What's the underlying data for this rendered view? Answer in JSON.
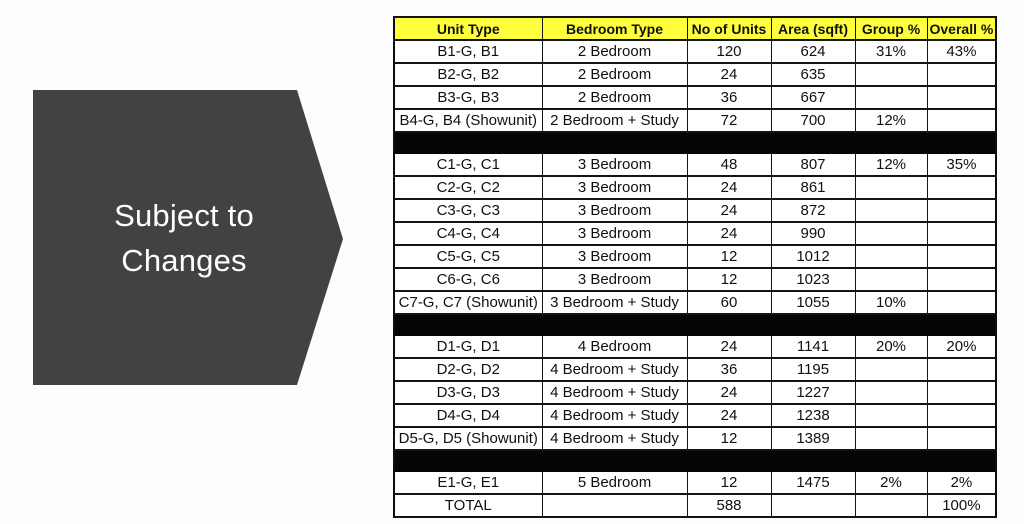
{
  "page": {
    "background_color": "#fdfdfd"
  },
  "callout": {
    "line1": "Subject to",
    "line2": "Changes",
    "shape_color": "#424242",
    "text_color": "#ffffff"
  },
  "table": {
    "header_bg": "#ffff3e",
    "divider_color": "#050505",
    "columns": [
      "Unit Type",
      "Bedroom Type",
      "No of Units",
      "Area (sqft)",
      "Group %",
      "Overall %"
    ],
    "column_keys": [
      "unit-type",
      "bedroom-type",
      "no-of-units",
      "area-sqft",
      "group-pct",
      "overall-pct"
    ],
    "rows": [
      {
        "type": "data",
        "cells": [
          "B1-G, B1",
          "2 Bedroom",
          "120",
          "624",
          "31%",
          "43%"
        ]
      },
      {
        "type": "data",
        "cells": [
          "B2-G, B2",
          "2 Bedroom",
          "24",
          "635",
          "",
          ""
        ]
      },
      {
        "type": "data",
        "cells": [
          "B3-G, B3",
          "2 Bedroom",
          "36",
          "667",
          "",
          ""
        ]
      },
      {
        "type": "data",
        "cells": [
          "B4-G, B4 (Showunit)",
          "2 Bedroom + Study",
          "72",
          "700",
          "12%",
          ""
        ]
      },
      {
        "type": "separator",
        "cells": []
      },
      {
        "type": "data",
        "cells": [
          "C1-G, C1",
          "3 Bedroom",
          "48",
          "807",
          "12%",
          "35%"
        ]
      },
      {
        "type": "data",
        "cells": [
          "C2-G, C2",
          "3 Bedroom",
          "24",
          "861",
          "",
          ""
        ]
      },
      {
        "type": "data",
        "cells": [
          "C3-G, C3",
          "3 Bedroom",
          "24",
          "872",
          "",
          ""
        ]
      },
      {
        "type": "data",
        "cells": [
          "C4-G, C4",
          "3 Bedroom",
          "24",
          "990",
          "",
          ""
        ]
      },
      {
        "type": "data",
        "cells": [
          "C5-G, C5",
          "3 Bedroom",
          "12",
          "1012",
          "",
          ""
        ]
      },
      {
        "type": "data",
        "cells": [
          "C6-G, C6",
          "3 Bedroom",
          "12",
          "1023",
          "",
          ""
        ]
      },
      {
        "type": "data",
        "cells": [
          "C7-G, C7 (Showunit)",
          "3 Bedroom + Study",
          "60",
          "1055",
          "10%",
          ""
        ]
      },
      {
        "type": "separator",
        "cells": []
      },
      {
        "type": "data",
        "cells": [
          "D1-G, D1",
          "4 Bedroom",
          "24",
          "1141",
          "20%",
          "20%"
        ]
      },
      {
        "type": "data",
        "cells": [
          "D2-G, D2",
          "4 Bedroom + Study",
          "36",
          "1195",
          "",
          ""
        ]
      },
      {
        "type": "data",
        "cells": [
          "D3-G, D3",
          "4 Bedroom + Study",
          "24",
          "1227",
          "",
          ""
        ]
      },
      {
        "type": "data",
        "cells": [
          "D4-G, D4",
          "4 Bedroom + Study",
          "24",
          "1238",
          "",
          ""
        ]
      },
      {
        "type": "data",
        "cells": [
          "D5-G, D5 (Showunit)",
          "4 Bedroom + Study",
          "12",
          "1389",
          "",
          ""
        ]
      },
      {
        "type": "separator",
        "cells": []
      },
      {
        "type": "data",
        "cells": [
          "E1-G, E1",
          "5 Bedroom",
          "12",
          "1475",
          "2%",
          "2%"
        ]
      },
      {
        "type": "total",
        "cells": [
          "TOTAL",
          "",
          "588",
          "",
          "",
          "100%"
        ]
      }
    ]
  }
}
